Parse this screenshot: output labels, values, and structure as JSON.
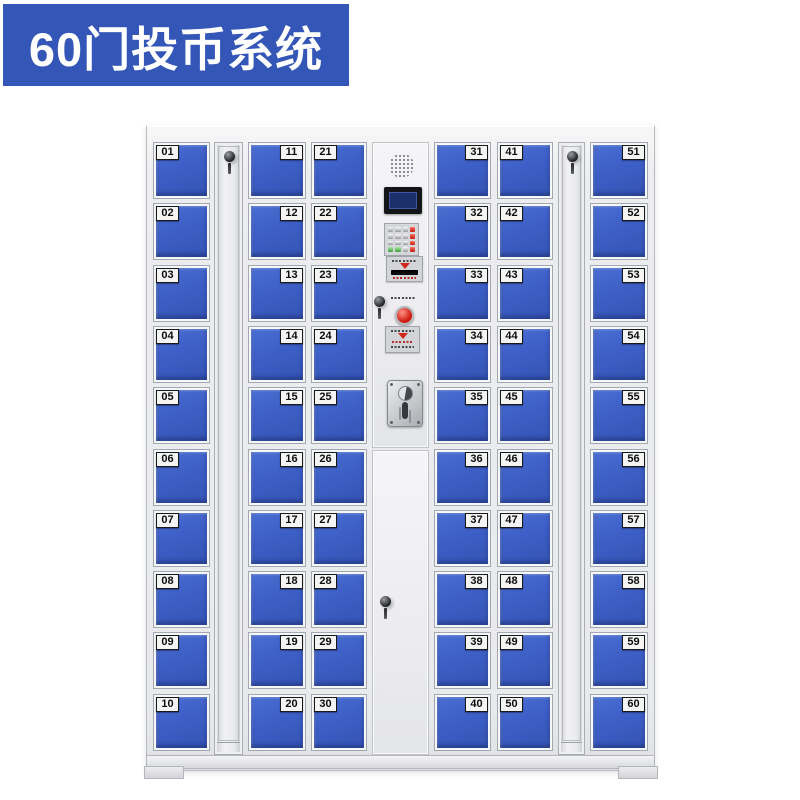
{
  "badge": {
    "label": "60门投币系统",
    "background": "#3456b7",
    "text_color": "#ffffff"
  },
  "locker": {
    "door_color": "#3d5fc6",
    "frame_color": "#e9eaec",
    "number_plate_color": "#f4f4f2",
    "door_columns": [
      {
        "label_side": "left",
        "numbers": [
          "01",
          "02",
          "03",
          "04",
          "05",
          "06",
          "07",
          "08",
          "09",
          "10"
        ]
      },
      {
        "label_side": "right",
        "numbers": [
          "11",
          "12",
          "13",
          "14",
          "15",
          "16",
          "17",
          "18",
          "19",
          "20"
        ]
      },
      {
        "label_side": "left",
        "numbers": [
          "21",
          "22",
          "23",
          "24",
          "25",
          "26",
          "27",
          "28",
          "29",
          "30"
        ]
      },
      {
        "label_side": "right",
        "numbers": [
          "31",
          "32",
          "33",
          "34",
          "35",
          "36",
          "37",
          "38",
          "39",
          "40"
        ]
      },
      {
        "label_side": "left",
        "numbers": [
          "41",
          "42",
          "43",
          "44",
          "45",
          "46",
          "47",
          "48",
          "49",
          "50"
        ]
      },
      {
        "label_side": "right",
        "numbers": [
          "51",
          "52",
          "53",
          "54",
          "55",
          "56",
          "57",
          "58",
          "59",
          "60"
        ]
      }
    ],
    "side_lock_panels": 2,
    "control_panel": {
      "components": [
        "speaker",
        "lcd-display",
        "numeric-keypad",
        "ticket-slot",
        "service-key-lock",
        "coin-return-button",
        "instruction-label",
        "coin-acceptor",
        "lower-door-lock"
      ],
      "screen_color": "#1d2f6b",
      "button_color": "#cf1a0d",
      "keypad_rows": 4,
      "keypad_cols": 4
    }
  }
}
